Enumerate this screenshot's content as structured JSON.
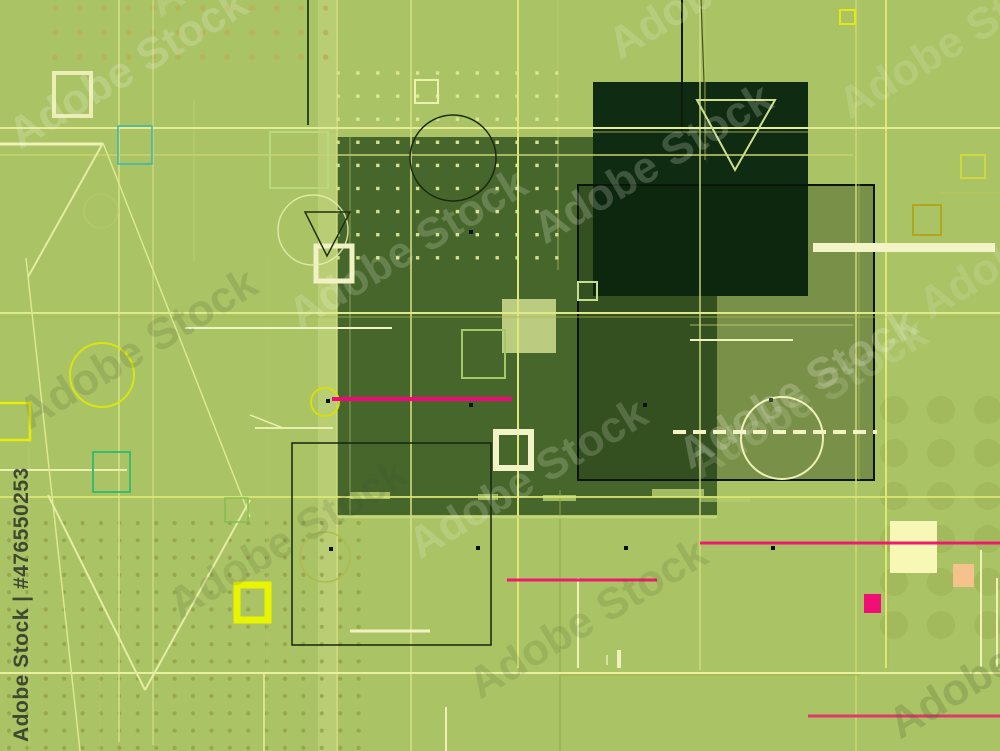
{
  "canvas": {
    "width": 1000,
    "height": 751,
    "background": "#a9c365"
  },
  "watermark": {
    "brand": "Adobe Stock",
    "stock_id_label": "Adobe Stock | #476550253",
    "light_color": "rgba(248,250,238,1)",
    "dark_color": "rgba(70,80,45,1)",
    "ghosts": [
      {
        "x": 20,
        "y": 150,
        "tone": "light",
        "o": 0.2
      },
      {
        "x": 160,
        "y": 18,
        "tone": "light",
        "o": 0.15
      },
      {
        "x": 300,
        "y": 330,
        "tone": "light",
        "o": 0.18
      },
      {
        "x": 545,
        "y": 245,
        "tone": "light",
        "o": 0.2
      },
      {
        "x": 620,
        "y": 60,
        "tone": "light",
        "o": 0.18
      },
      {
        "x": 690,
        "y": 470,
        "tone": "light",
        "o": 0.22
      },
      {
        "x": 700,
        "y": 480,
        "tone": "light",
        "o": 0.14
      },
      {
        "x": 850,
        "y": 120,
        "tone": "light",
        "o": 0.15
      },
      {
        "x": 420,
        "y": 560,
        "tone": "light",
        "o": 0.18
      },
      {
        "x": 30,
        "y": 430,
        "tone": "dark",
        "o": 0.16
      },
      {
        "x": 180,
        "y": 620,
        "tone": "dark",
        "o": 0.14
      },
      {
        "x": 480,
        "y": 700,
        "tone": "dark",
        "o": 0.14
      },
      {
        "x": 900,
        "y": 740,
        "tone": "dark",
        "o": 0.2
      },
      {
        "x": 930,
        "y": 320,
        "tone": "light",
        "o": 0.14
      }
    ]
  },
  "palette": {
    "background": "#a9c365",
    "central_dark_green": "#43622a",
    "near_black_green": "#0f2c12",
    "pale_yellow_line": "#dfe88a",
    "cream": "#f2f3c6",
    "bright_yellow": "#e9f400",
    "magenta": "#f1067b",
    "pink": "#ee1a6e",
    "teal": "#40b4ac",
    "spring_green": "#3cba6f",
    "peach": "#f5c28c"
  },
  "elements": [
    {
      "t": "r",
      "n": "pale-vertical-band",
      "x": 318,
      "y": 0,
      "w": 20,
      "h": 751,
      "c": "#e4ee9f",
      "o": 0.28
    },
    {
      "t": "g",
      "n": "faint-blob-grid",
      "x0": 894,
      "y0": 410,
      "cols": 3,
      "rows": 6,
      "dx": 47,
      "dy": 43,
      "shape": "circle",
      "size": 14,
      "c": "#8a9640",
      "o": 0.22
    },
    {
      "t": "g",
      "n": "bead-grid-top-left",
      "x0": 55,
      "y0": 8,
      "cols": 12,
      "rows": 3,
      "dx": 24.6,
      "dy": 24.6,
      "shape": "circle",
      "size": 2.8,
      "c": "#b9b257",
      "o": 0.95
    },
    {
      "t": "g",
      "n": "bead-grid-bottom-left",
      "x0": 9,
      "y0": 523,
      "cols": 20,
      "rows": 14,
      "dx": 18.4,
      "dy": 17.3,
      "shape": "circle",
      "size": 2.1,
      "c": "#99a04c",
      "o": 0.85
    },
    {
      "t": "r",
      "n": "central-dark-square",
      "x": 337,
      "y": 137,
      "w": 380,
      "h": 378,
      "c": "#43622a",
      "o": 0.96
    },
    {
      "t": "r",
      "n": "near-black-square",
      "x": 593,
      "y": 82,
      "w": 215,
      "h": 214,
      "c": "#0f2c12",
      "o": 1
    },
    {
      "t": "r",
      "n": "outlined-square-fill",
      "x": 578,
      "y": 185,
      "w": 296,
      "h": 295,
      "c": "#0a1c05",
      "o": 0.3
    },
    {
      "t": "o",
      "n": "outlined-square-border",
      "x": 578,
      "y": 185,
      "w": 296,
      "h": 295,
      "c": "#0d140c",
      "sw": 2
    },
    {
      "t": "r",
      "n": "smudge",
      "x": 350,
      "y": 492,
      "w": 40,
      "h": 7,
      "c": "#b9d272",
      "o": 0.8
    },
    {
      "t": "r",
      "n": "smudge",
      "x": 478,
      "y": 494,
      "w": 20,
      "h": 6,
      "c": "#b9d272",
      "o": 0.7
    },
    {
      "t": "r",
      "n": "smudge",
      "x": 543,
      "y": 495,
      "w": 33,
      "h": 6,
      "c": "#b9d272",
      "o": 0.8
    },
    {
      "t": "r",
      "n": "smudge",
      "x": 652,
      "y": 489,
      "w": 52,
      "h": 8,
      "c": "#b9d272",
      "o": 0.8
    },
    {
      "t": "r",
      "n": "smudge",
      "x": 700,
      "y": 497,
      "w": 50,
      "h": 5,
      "c": "#b9d272",
      "o": 0.6
    },
    {
      "t": "r",
      "n": "pale-translucent-square",
      "x": 502,
      "y": 299,
      "w": 54,
      "h": 54,
      "c": "#c5d488",
      "o": 0.92
    },
    {
      "t": "g",
      "n": "fine-dot-grid",
      "x0": 338,
      "y0": 73,
      "cols": 12,
      "rows": 9,
      "dx": 19.9,
      "dy": 23.1,
      "shape": "square",
      "size": 3.4,
      "c": "#dfe795",
      "o": 0.95
    },
    {
      "t": "l",
      "n": "vline",
      "x1": 119,
      "y1": 0,
      "x2": 119,
      "y2": 742,
      "c": "#d3df85",
      "w": 1.6
    },
    {
      "t": "l",
      "n": "vline",
      "x1": 153,
      "y1": 0,
      "x2": 153,
      "y2": 745,
      "c": "#cdd87e",
      "w": 1.4
    },
    {
      "t": "l",
      "n": "vline",
      "x1": 194,
      "y1": 100,
      "x2": 194,
      "y2": 262,
      "c": "#c3d173",
      "w": 1,
      "o": 0.7
    },
    {
      "t": "l",
      "n": "vline",
      "x1": 267,
      "y1": 255,
      "x2": 267,
      "y2": 745,
      "c": "#b7c464",
      "w": 1,
      "o": 0.6
    },
    {
      "t": "l",
      "n": "vline",
      "x1": 264,
      "y1": 672,
      "x2": 264,
      "y2": 751,
      "c": "#dfe88a",
      "w": 1.8
    },
    {
      "t": "l",
      "n": "dark-vline",
      "x1": 308,
      "y1": 0,
      "x2": 308,
      "y2": 125,
      "c": "#2c4a1e",
      "w": 2
    },
    {
      "t": "l",
      "n": "vline",
      "x1": 337,
      "y1": 0,
      "x2": 337,
      "y2": 751,
      "c": "#cfdd7e",
      "w": 1.5,
      "o": 0.9
    },
    {
      "t": "l",
      "n": "vline",
      "x1": 350,
      "y1": 137,
      "x2": 350,
      "y2": 515,
      "c": "#c8dc78",
      "w": 1,
      "o": 0.5
    },
    {
      "t": "l",
      "n": "vline",
      "x1": 411,
      "y1": 0,
      "x2": 411,
      "y2": 751,
      "c": "#d6e284",
      "w": 1.5
    },
    {
      "t": "l",
      "n": "vline",
      "x1": 446,
      "y1": 707,
      "x2": 446,
      "y2": 751,
      "c": "#eef2b8",
      "w": 2
    },
    {
      "t": "l",
      "n": "vline",
      "x1": 518,
      "y1": 0,
      "x2": 518,
      "y2": 668,
      "c": "#dce878",
      "w": 2
    },
    {
      "t": "l",
      "n": "vline",
      "x1": 558,
      "y1": 0,
      "x2": 558,
      "y2": 270,
      "c": "#c9d670",
      "w": 1,
      "o": 0.6
    },
    {
      "t": "l",
      "n": "vline",
      "x1": 560,
      "y1": 490,
      "x2": 560,
      "y2": 751,
      "c": "#98a54a",
      "w": 1.2,
      "o": 0.8
    },
    {
      "t": "l",
      "n": "vline",
      "x1": 578,
      "y1": 578,
      "x2": 578,
      "y2": 668,
      "c": "#eef2b8",
      "w": 2
    },
    {
      "t": "l",
      "n": "vline",
      "x1": 607,
      "y1": 655,
      "x2": 607,
      "y2": 665,
      "c": "#e6ecb0",
      "w": 1.5
    },
    {
      "t": "l",
      "n": "vline-thick-short",
      "x1": 619,
      "y1": 650,
      "x2": 619,
      "y2": 668,
      "c": "#f0f2bc",
      "w": 4
    },
    {
      "t": "l",
      "n": "black-vline",
      "x1": 682,
      "y1": 0,
      "x2": 682,
      "y2": 133,
      "c": "#0e1d0b",
      "w": 2
    },
    {
      "t": "l",
      "n": "vline",
      "x1": 700,
      "y1": 0,
      "x2": 700,
      "y2": 670,
      "c": "#d4e080",
      "w": 1.5,
      "o": 0.9
    },
    {
      "t": "l",
      "n": "dark-diagonal-thin",
      "x1": 701,
      "y1": 0,
      "x2": 707,
      "y2": 163,
      "c": "#2a3d18",
      "w": 1.2,
      "o": 0.8
    },
    {
      "t": "l",
      "n": "vline",
      "x1": 705,
      "y1": 0,
      "x2": 705,
      "y2": 160,
      "c": "#c3cf6f",
      "w": 1,
      "o": 0.7
    },
    {
      "t": "l",
      "n": "vline",
      "x1": 856,
      "y1": 0,
      "x2": 856,
      "y2": 751,
      "c": "#cdd977",
      "w": 1.5
    },
    {
      "t": "l",
      "n": "vline",
      "x1": 859,
      "y1": 0,
      "x2": 859,
      "y2": 480,
      "c": "#b9c765",
      "w": 1,
      "o": 0.6
    },
    {
      "t": "l",
      "n": "vline",
      "x1": 886,
      "y1": 0,
      "x2": 886,
      "y2": 668,
      "c": "#dce878",
      "w": 2
    },
    {
      "t": "l",
      "n": "vline",
      "x1": 888,
      "y1": 583,
      "x2": 888,
      "y2": 667,
      "c": "#aab85a",
      "w": 1,
      "o": 0.7
    },
    {
      "t": "l",
      "n": "vline",
      "x1": 981,
      "y1": 550,
      "x2": 981,
      "y2": 667,
      "c": "#eef2b8",
      "w": 2
    },
    {
      "t": "l",
      "n": "vline",
      "x1": 997,
      "y1": 578,
      "x2": 997,
      "y2": 667,
      "c": "#eef2b8",
      "w": 2
    },
    {
      "t": "l",
      "n": "vline",
      "x1": 29,
      "y1": 395,
      "x2": 29,
      "y2": 751,
      "c": "#c3d173",
      "w": 1,
      "o": 0.6
    },
    {
      "t": "l",
      "n": "vline",
      "x1": 100,
      "y1": 620,
      "x2": 100,
      "y2": 751,
      "c": "#bcc96b",
      "w": 1,
      "o": 0.6
    },
    {
      "t": "l",
      "n": "hline",
      "x1": 0,
      "y1": 128,
      "x2": 1000,
      "y2": 128,
      "c": "#e4ec96",
      "w": 2
    },
    {
      "t": "l",
      "n": "hline",
      "x1": 0,
      "y1": 132,
      "x2": 1000,
      "y2": 132,
      "c": "#b8c468",
      "w": 1,
      "o": 0.8
    },
    {
      "t": "l",
      "n": "hline-thick",
      "x1": 0,
      "y1": 144,
      "x2": 103,
      "y2": 144,
      "c": "#eef2b8",
      "w": 3
    },
    {
      "t": "l",
      "n": "hline",
      "x1": 0,
      "y1": 155,
      "x2": 853,
      "y2": 155,
      "c": "#c8d16e",
      "w": 1.5
    },
    {
      "t": "l",
      "n": "hline",
      "x1": 941,
      "y1": 193,
      "x2": 1000,
      "y2": 193,
      "c": "#b9c45f",
      "w": 1.5
    },
    {
      "t": "l",
      "n": "hline",
      "x1": 0,
      "y1": 313,
      "x2": 1000,
      "y2": 313,
      "c": "#dfe88a",
      "w": 2
    },
    {
      "t": "l",
      "n": "hline",
      "x1": 0,
      "y1": 317,
      "x2": 1000,
      "y2": 317,
      "c": "#aab84f",
      "w": 1,
      "o": 0.8
    },
    {
      "t": "l",
      "n": "hline-white",
      "x1": 185,
      "y1": 328,
      "x2": 392,
      "y2": 328,
      "c": "#f0f4c4",
      "w": 2
    },
    {
      "t": "l",
      "n": "hline",
      "x1": 690,
      "y1": 325,
      "x2": 853,
      "y2": 325,
      "c": "#c8d16e",
      "w": 1,
      "o": 0.8
    },
    {
      "t": "l",
      "n": "hline-white",
      "x1": 690,
      "y1": 340,
      "x2": 793,
      "y2": 340,
      "c": "#eff3c0",
      "w": 2
    },
    {
      "t": "l",
      "n": "hline",
      "x1": 255,
      "y1": 428,
      "x2": 333,
      "y2": 428,
      "c": "#e9efad",
      "w": 2
    },
    {
      "t": "l",
      "n": "hline",
      "x1": 0,
      "y1": 470,
      "x2": 127,
      "y2": 470,
      "c": "#e9efad",
      "w": 2
    },
    {
      "t": "l",
      "n": "hline",
      "x1": 0,
      "y1": 497,
      "x2": 1000,
      "y2": 497,
      "c": "#dce773",
      "w": 1.8
    },
    {
      "t": "l",
      "n": "hline",
      "x1": 337,
      "y1": 517,
      "x2": 717,
      "y2": 517,
      "c": "#c8d67c",
      "w": 2.5,
      "o": 0.9
    },
    {
      "t": "l",
      "n": "hline",
      "x1": 350,
      "y1": 631,
      "x2": 430,
      "y2": 631,
      "c": "#f2f3c3",
      "w": 3
    },
    {
      "t": "l",
      "n": "hline",
      "x1": 0,
      "y1": 673,
      "x2": 1000,
      "y2": 673,
      "c": "#e8efa0",
      "w": 2
    },
    {
      "t": "l",
      "n": "hline-olive",
      "x1": 560,
      "y1": 675,
      "x2": 860,
      "y2": 675,
      "c": "#aab545",
      "w": 1.5,
      "o": 0.8
    },
    {
      "t": "l",
      "n": "triangle-left-side",
      "x1": 103,
      "y1": 143,
      "x2": 28,
      "y2": 277,
      "c": "#e5eca0",
      "w": 2
    },
    {
      "t": "l",
      "n": "diagonal",
      "x1": 26,
      "y1": 258,
      "x2": 80,
      "y2": 751,
      "c": "#dde890",
      "w": 1.5
    },
    {
      "t": "l",
      "n": "triangle-hypotenuse",
      "x1": 103,
      "y1": 143,
      "x2": 250,
      "y2": 517,
      "c": "#dde890",
      "w": 1.5
    },
    {
      "t": "l",
      "n": "v-left-arm",
      "x1": 48,
      "y1": 495,
      "x2": 145,
      "y2": 690,
      "c": "#e5eca4",
      "w": 2
    },
    {
      "t": "l",
      "n": "v-right-arm",
      "x1": 145,
      "y1": 690,
      "x2": 250,
      "y2": 500,
      "c": "#e5eca4",
      "w": 2
    },
    {
      "t": "l",
      "n": "short-diagonal",
      "x1": 250,
      "y1": 415,
      "x2": 283,
      "y2": 428,
      "c": "#e9efad",
      "w": 1.5
    },
    {
      "t": "o",
      "n": "yellow-square-outline-topleft",
      "x": 54,
      "y": 73,
      "w": 37,
      "h": 43,
      "c": "#edeeb5",
      "sw": 4
    },
    {
      "t": "o",
      "n": "teal-square-outline",
      "x": 118,
      "y": 126,
      "w": 34,
      "h": 38,
      "c": "#40b4ac",
      "sw": 1.5
    },
    {
      "t": "o",
      "n": "lightgreen-square-outline",
      "x": 270,
      "y": 132,
      "w": 58,
      "h": 56,
      "c": "#bad87d",
      "sw": 2
    },
    {
      "t": "o",
      "n": "pale-square-outline",
      "x": 415,
      "y": 80,
      "w": 23,
      "h": 23,
      "c": "#eef0b0",
      "sw": 2
    },
    {
      "t": "o",
      "n": "cream-square-a",
      "x": 316,
      "y": 246,
      "w": 36,
      "h": 35,
      "c": "#f1f2c3",
      "sw": 5
    },
    {
      "t": "o",
      "n": "lightgreen-square-outline",
      "x": 462,
      "y": 330,
      "w": 43,
      "h": 48,
      "c": "#a3c967",
      "sw": 2
    },
    {
      "t": "o",
      "n": "green-square-outline-small",
      "x": 578,
      "y": 282,
      "w": 19,
      "h": 18,
      "c": "#c4dd8e",
      "sw": 2
    },
    {
      "t": "o",
      "n": "cream-square-b",
      "x": 496,
      "y": 432,
      "w": 35,
      "h": 36,
      "c": "#f3f3c8",
      "sw": 6
    },
    {
      "t": "o",
      "n": "black-square-outline-bottom",
      "x": 292,
      "y": 443,
      "w": 199,
      "h": 202,
      "c": "#17250f",
      "sw": 1.5
    },
    {
      "t": "o",
      "n": "spring-green-square",
      "x": 93,
      "y": 452,
      "w": 37,
      "h": 40,
      "c": "#3cba6f",
      "sw": 2
    },
    {
      "t": "o",
      "n": "green-square-outline",
      "x": 225,
      "y": 498,
      "w": 23,
      "h": 24,
      "c": "#83c04f",
      "sw": 1.5
    },
    {
      "t": "o",
      "n": "yellow-square-outline-left",
      "x": -8,
      "y": 403,
      "w": 38,
      "h": 37,
      "c": "#e7ec08",
      "sw": 2.5
    },
    {
      "t": "o",
      "n": "bright-yellow-square",
      "x": 237,
      "y": 585,
      "w": 31,
      "h": 35,
      "c": "#e9f400",
      "sw": 7
    },
    {
      "t": "o",
      "n": "yellow-square-outline-topright",
      "x": 840,
      "y": 10,
      "w": 15,
      "h": 14,
      "c": "#e4e713",
      "sw": 2
    },
    {
      "t": "o",
      "n": "olive-square-outline",
      "x": 913,
      "y": 205,
      "w": 28,
      "h": 30,
      "c": "#b2a71c",
      "sw": 2
    },
    {
      "t": "o",
      "n": "yellowgreen-square-outline",
      "x": 961,
      "y": 155,
      "w": 24,
      "h": 23,
      "c": "#ced83f",
      "sw": 2
    },
    {
      "t": "r",
      "n": "cream-filled-square",
      "x": 890,
      "y": 521,
      "w": 47,
      "h": 52,
      "c": "#f7f8b6",
      "o": 1
    },
    {
      "t": "r",
      "n": "peach-square",
      "x": 953,
      "y": 564,
      "w": 21,
      "h": 23,
      "c": "#f5c28c",
      "o": 1
    },
    {
      "t": "r",
      "n": "magenta-square",
      "x": 864,
      "y": 594,
      "w": 17,
      "h": 19,
      "c": "#ef0f76",
      "o": 1
    },
    {
      "t": "r",
      "n": "cream-bar",
      "x": 813,
      "y": 243,
      "w": 182,
      "h": 9,
      "c": "#f2f3c6",
      "o": 1
    },
    {
      "t": "c",
      "n": "black-circle-outline",
      "cx": 453,
      "cy": 158,
      "r": 43,
      "c": "#1b2912",
      "sw": 1.5
    },
    {
      "t": "c",
      "n": "faint-circle",
      "cx": 101,
      "cy": 211,
      "r": 17,
      "c": "#b9c869",
      "sw": 1.5,
      "o": 0.8
    },
    {
      "t": "c",
      "n": "pale-circle",
      "cx": 313,
      "cy": 230,
      "r": 35,
      "c": "#e6eeae",
      "sw": 1.5,
      "o": 0.85
    },
    {
      "t": "c",
      "n": "yellow-circle",
      "cx": 102,
      "cy": 375,
      "r": 32,
      "c": "#d9e414",
      "sw": 2
    },
    {
      "t": "c",
      "n": "small-yellow-circle",
      "cx": 325,
      "cy": 402,
      "r": 14,
      "c": "#d6e00a",
      "sw": 2
    },
    {
      "t": "c",
      "n": "olive-circle",
      "cx": 325,
      "cy": 557,
      "r": 25,
      "c": "#aeba4e",
      "sw": 1.5
    },
    {
      "t": "c",
      "n": "pale-circle-right",
      "cx": 782,
      "cy": 438,
      "r": 41,
      "c": "#eef0b4",
      "sw": 2
    },
    {
      "t": "p",
      "n": "pale-inverted-triangle",
      "pts": "697,100 775,100 735,170",
      "c": "#cfdf8e",
      "sw": 2
    },
    {
      "t": "p",
      "n": "dark-triangle-outline",
      "pts": "305,212 350,212 327,256",
      "c": "#22300f",
      "sw": 1.5
    },
    {
      "t": "l",
      "n": "magenta-line-1",
      "x1": 332,
      "y1": 399,
      "x2": 512,
      "y2": 399,
      "c": "#f1067b",
      "w": 4
    },
    {
      "t": "l",
      "n": "dashed-cream-line",
      "x1": 673,
      "y1": 432,
      "x2": 877,
      "y2": 432,
      "c": "#f3f4c2",
      "w": 4,
      "d": "13 7"
    },
    {
      "t": "l",
      "n": "magenta-line-2",
      "x1": 700,
      "y1": 543,
      "x2": 1000,
      "y2": 543,
      "c": "#ee1a6e",
      "w": 3
    },
    {
      "t": "l",
      "n": "magenta-line-3",
      "x1": 507,
      "y1": 580,
      "x2": 657,
      "y2": 580,
      "c": "#ee1a6e",
      "w": 3
    },
    {
      "t": "l",
      "n": "magenta-line-4",
      "x1": 808,
      "y1": 716,
      "x2": 1000,
      "y2": 716,
      "c": "#dd3a6b",
      "w": 3
    },
    {
      "t": "d",
      "n": "black-dot",
      "x": 471,
      "y": 232,
      "s": 4,
      "c": "#0a0f08"
    },
    {
      "t": "d",
      "n": "black-dot",
      "x": 328,
      "y": 401,
      "s": 4,
      "c": "#0a0f08"
    },
    {
      "t": "d",
      "n": "black-dot",
      "x": 471,
      "y": 405,
      "s": 4,
      "c": "#0a0f08"
    },
    {
      "t": "d",
      "n": "black-dot",
      "x": 645,
      "y": 405,
      "s": 4,
      "c": "#0a0f08"
    },
    {
      "t": "d",
      "n": "black-dot",
      "x": 771,
      "y": 400,
      "s": 4,
      "c": "#0a0f08"
    },
    {
      "t": "d",
      "n": "black-dot",
      "x": 331,
      "y": 549,
      "s": 4,
      "c": "#0a0f08"
    },
    {
      "t": "d",
      "n": "black-dot",
      "x": 478,
      "y": 548,
      "s": 4,
      "c": "#0a0f08"
    },
    {
      "t": "d",
      "n": "black-dot",
      "x": 626,
      "y": 548,
      "s": 4,
      "c": "#0a0f08"
    },
    {
      "t": "d",
      "n": "black-dot",
      "x": 773,
      "y": 548,
      "s": 4,
      "c": "#0a0f08"
    }
  ]
}
